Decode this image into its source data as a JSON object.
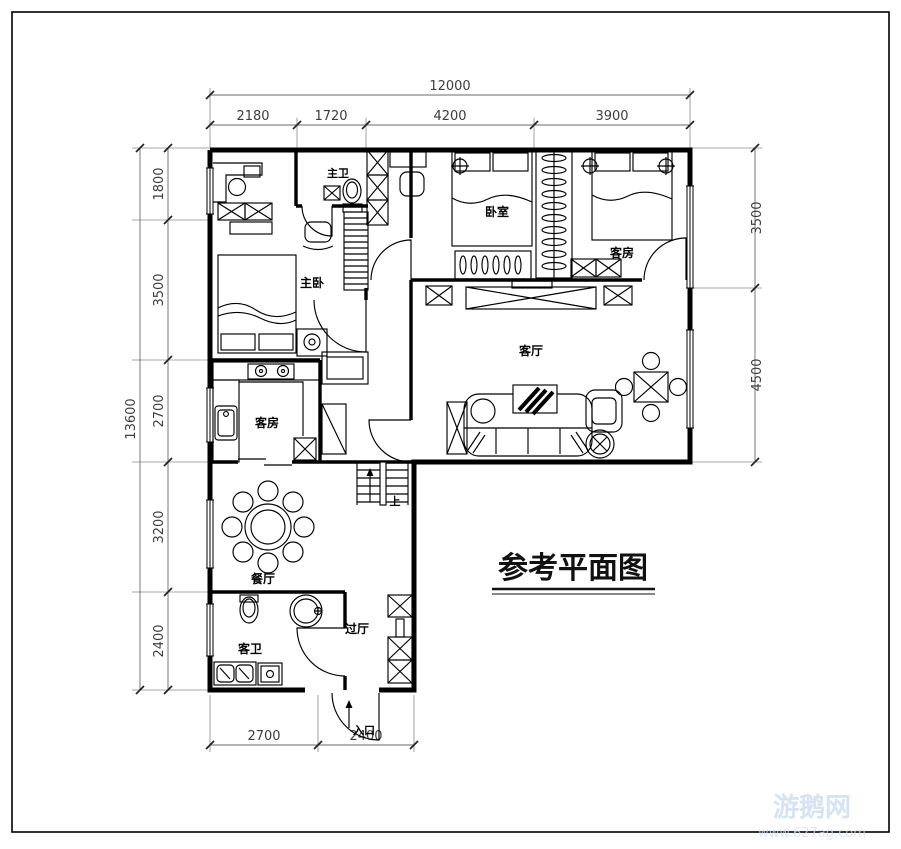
{
  "image": {
    "type": "reference-floor-plan",
    "background": "#ffffff"
  },
  "title": {
    "text": "参考平面图"
  },
  "rooms": {
    "master_bath": "主卫",
    "bedroom": "卧室",
    "guest_room_top": "客房",
    "master_bedroom": "主卧",
    "living_room": "客厅",
    "guest_room_mid": "客房",
    "dining_room": "餐厅",
    "guest_bath": "客卫",
    "hallway": "过厅"
  },
  "annotations": {
    "entrance": "入口",
    "stairs_up": "上"
  },
  "dimensions": {
    "top_total": "12000",
    "top_segments": [
      "2180",
      "1720",
      "4200",
      "3900"
    ],
    "left_total": "13600",
    "left_segments": [
      "1800",
      "3500",
      "2700",
      "3200",
      "2400"
    ],
    "right_segments": [
      "3500",
      "4500"
    ],
    "bottom_segments": [
      "2700",
      "2400"
    ]
  },
  "watermark": {
    "site": "游鹅网",
    "url": "www.627ag.com"
  },
  "colors": {
    "line": "#000000",
    "dim_text": "#3d3d3d",
    "watermark": "#cfe0f0"
  }
}
